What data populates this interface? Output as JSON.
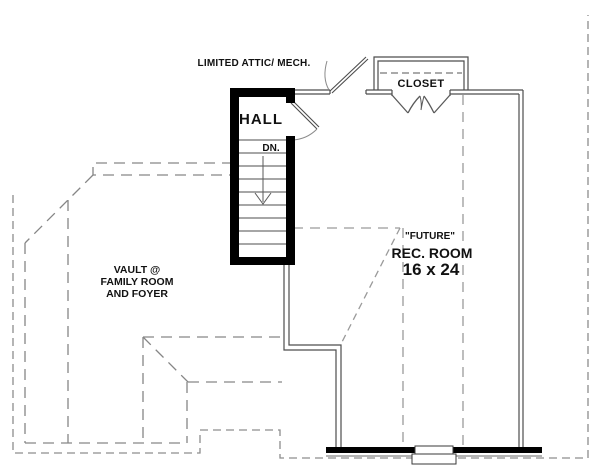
{
  "plan": {
    "attic_label": "LIMITED ATTIC/ MECH.",
    "hall_label": "HALL",
    "stairs_direction_label": "DN.",
    "closet_label": "CLOSET",
    "future_label": "\"FUTURE\"",
    "rec_room_label": "REC. ROOM",
    "rec_room_size": "16 x 24",
    "vault_note_line1": "VAULT @",
    "vault_note_line2": "FAMILY ROOM",
    "vault_note_line3": "AND FOYER"
  },
  "colors": {
    "solid_wall": "#000000",
    "thin_wall": "#4d4d4d",
    "dashed_line": "#8d8d8d",
    "text": "#111111",
    "background": "#ffffff"
  }
}
